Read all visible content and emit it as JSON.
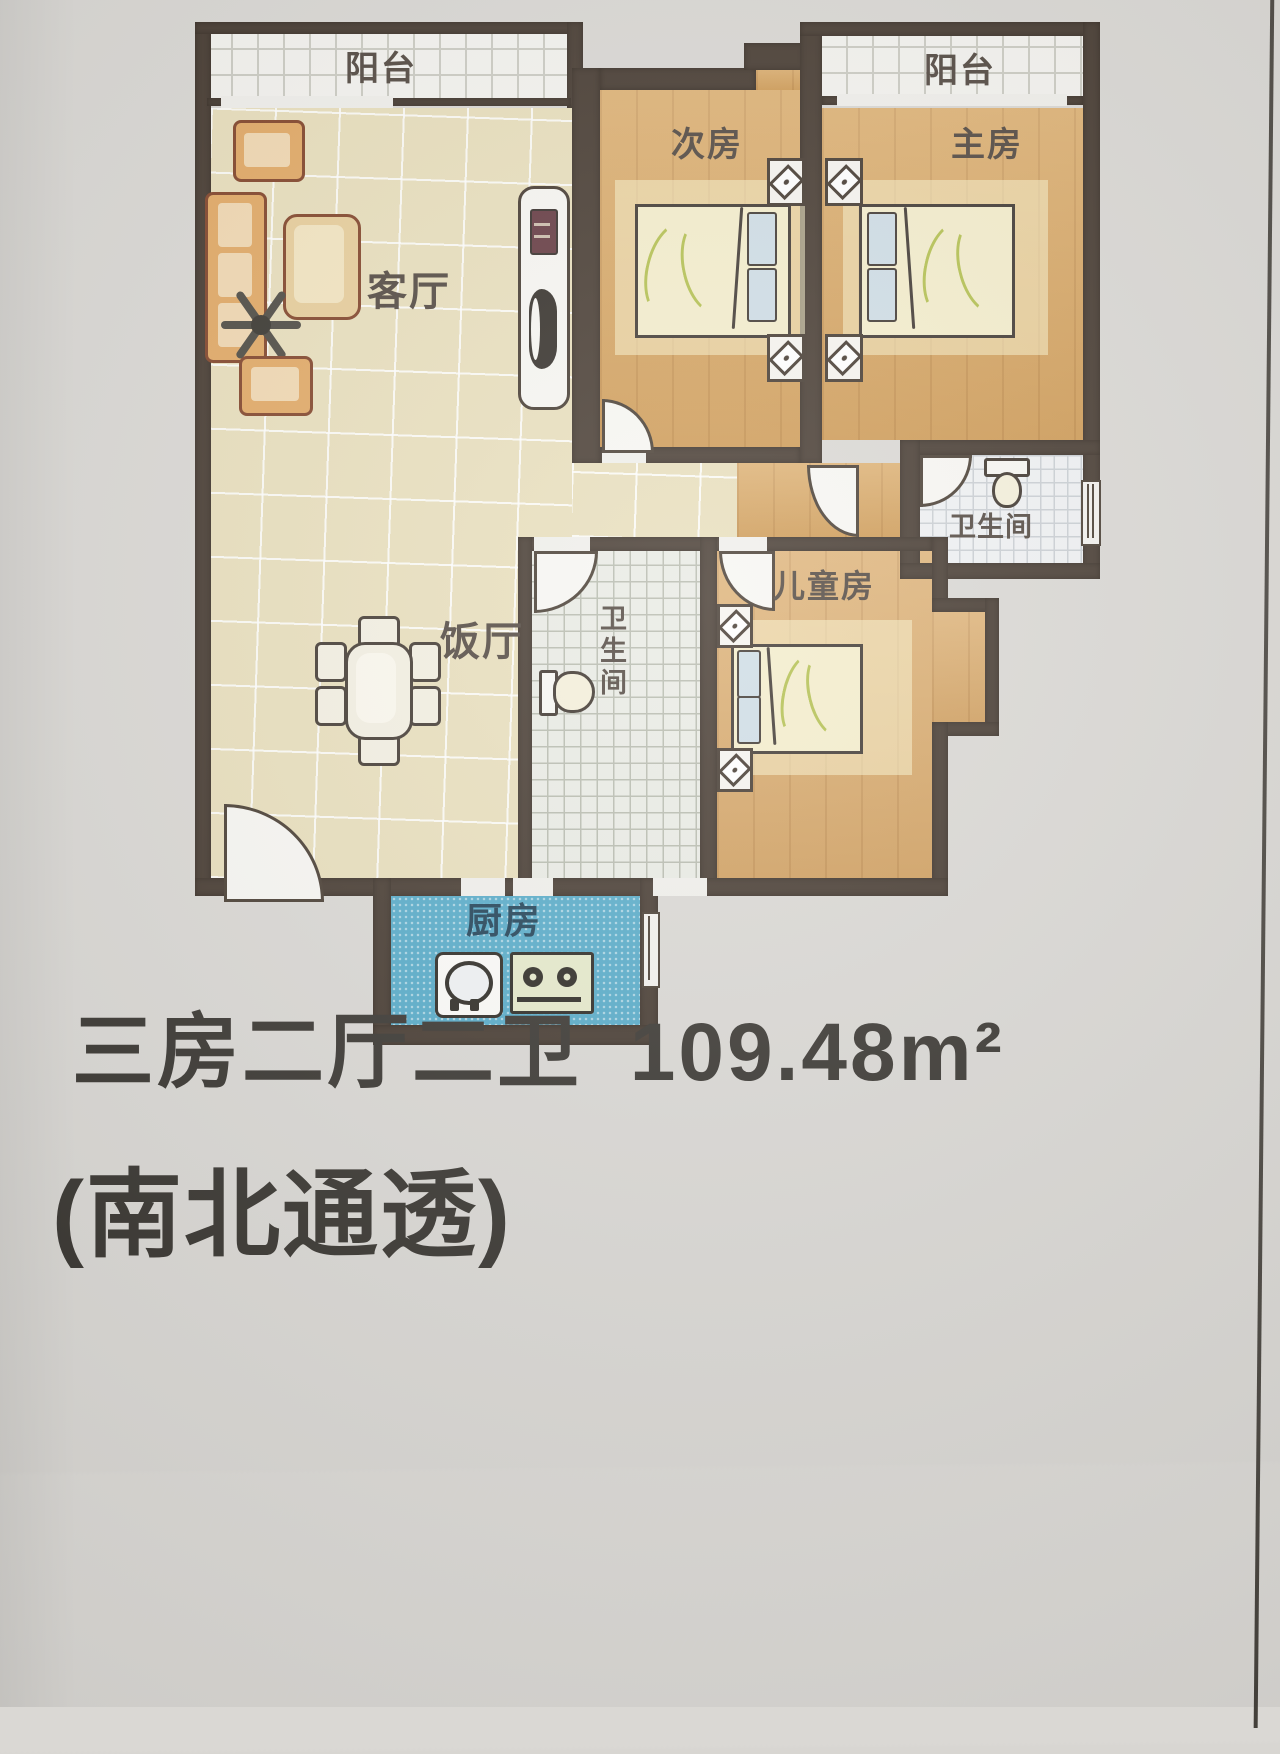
{
  "floorplan": {
    "rooms": {
      "balcony_left": {
        "label": "阳台"
      },
      "balcony_right": {
        "label": "阳台"
      },
      "living_room": {
        "label": "客厅"
      },
      "second_bedroom": {
        "label": "次房"
      },
      "master_bedroom": {
        "label": "主房"
      },
      "bathroom_right": {
        "label": "卫生间"
      },
      "dining_room": {
        "label": "饭厅"
      },
      "bathroom_center": {
        "label": "卫生间"
      },
      "kids_room": {
        "label": "儿童房"
      },
      "kitchen": {
        "label": "厨房"
      }
    },
    "colors": {
      "wall": "#3e3228",
      "bedroom_floor": "#d7a258",
      "living_floor": "#e7ddb9",
      "kitchen_blue": "#4fa7c6",
      "bath_tile": "#eef0f2",
      "room_label_text": "#4a4038",
      "kitchen_label_text": "#16394f",
      "caption_text": "#302d28",
      "paper": "#d8d6d2",
      "bottom_band": "#c9a77e"
    }
  },
  "caption": {
    "layout": "三房二厅二卫",
    "area": "109.48m²",
    "line1": "三房二厅二卫 109.48m²",
    "line2": "(南北通透)"
  }
}
